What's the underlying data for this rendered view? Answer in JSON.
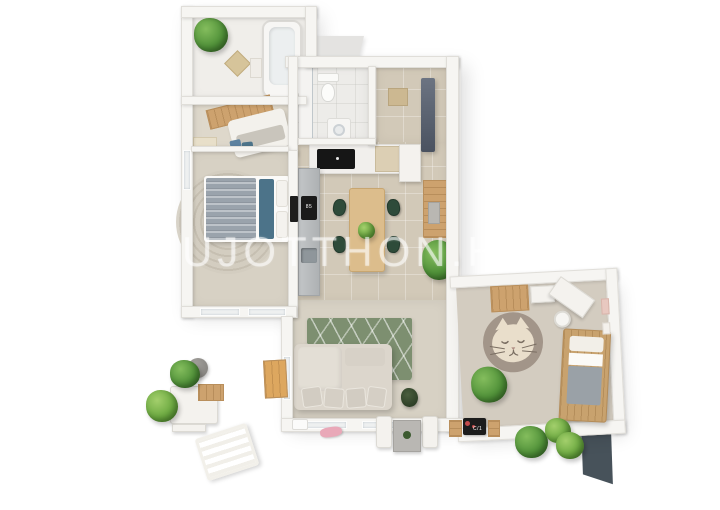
{
  "meta": {
    "scene_type": "3d-apartment-floor-plan-render",
    "background": "#ffffff"
  },
  "watermark": {
    "text": "UJOTTHON.HU"
  },
  "palette": {
    "wall": "#f6f5f2",
    "tile_beige": "#d2c9b8",
    "tile_white": "#edece9",
    "carpet": "#d7d1c4",
    "terrace_tile": "#a7a5a2",
    "rug_green": "#7d8f70",
    "rug_cat": "#a29589",
    "wood": "#cda26e",
    "chair_green": "#2e4b3a",
    "bed_blue": "#4c7389",
    "bed_gray": "#9aa3ac",
    "slate_wall": "#47525a",
    "plant_green": "#4f9038"
  },
  "rooms": {
    "bathroom_top": {
      "label": "bathroom with bathtub"
    },
    "bedroom_nook": {
      "label": "small bedroom nook"
    },
    "master_bedroom": {
      "label": "master bedroom"
    },
    "bathroom_main": {
      "label": "bathroom with toilet and washer"
    },
    "kitchen": {
      "label": "kitchen"
    },
    "dining_area": {
      "label": "dining area"
    },
    "hallway": {
      "label": "hallway"
    },
    "living_room": {
      "label": "living room"
    },
    "kids_room": {
      "label": "kids room"
    },
    "terrace": {
      "label": "terrace"
    }
  },
  "items": {
    "oven_display": "85",
    "doormat_text": "C/1"
  }
}
